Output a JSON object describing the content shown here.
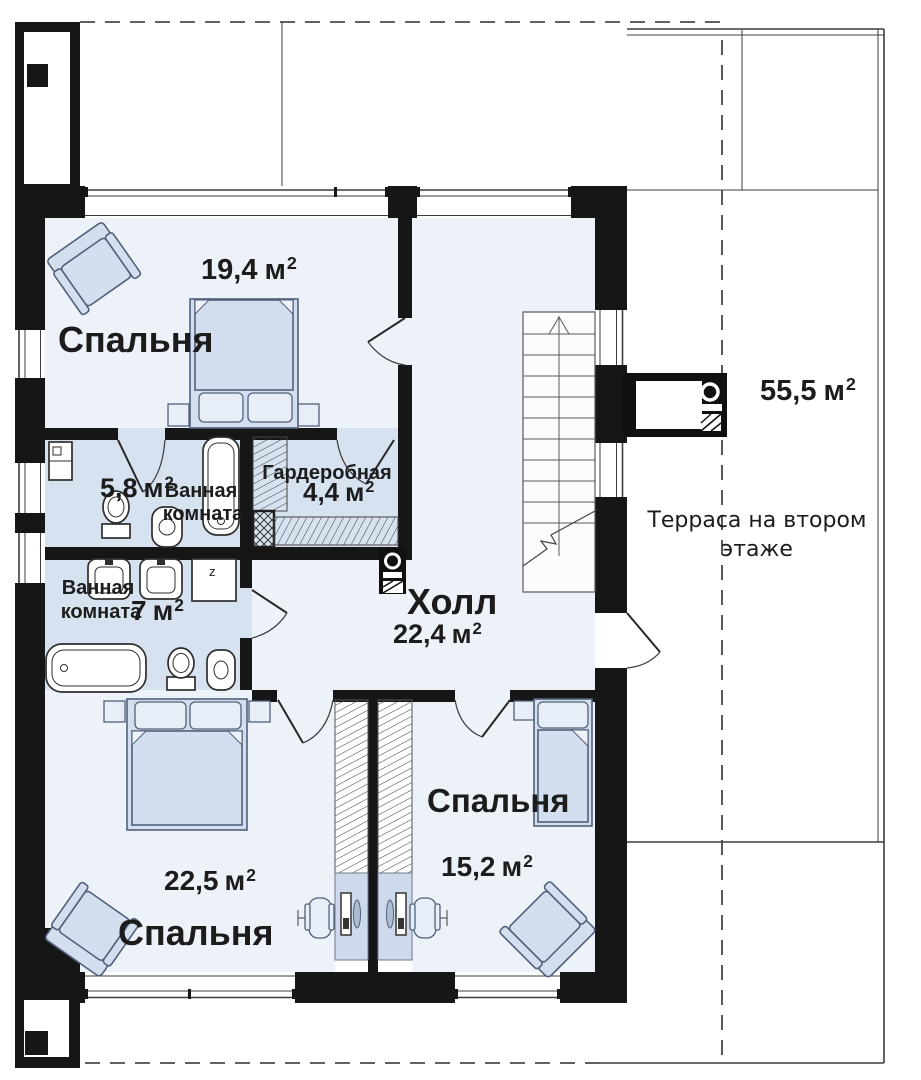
{
  "palette": {
    "wall": "#161616",
    "room": "#edf2f9",
    "wet": "#d7e2f1",
    "alcove": "#cddaeb",
    "furn": "#d3dfee",
    "furnLight": "#e8eef7",
    "outline": "#51617a",
    "text": "#1c1c1c"
  },
  "units": {
    "label": "м",
    "sup": "2"
  },
  "appliances": {
    "washer_label": "z"
  },
  "rooms": {
    "bedroom1": {
      "name": "Спальня",
      "area": "19,4"
    },
    "bathroom1": {
      "name_line1": "Ванная",
      "name_line2": "комната",
      "area": "5,8"
    },
    "wardrobe": {
      "name": "Гардеробная",
      "area": "4,4"
    },
    "bathroom2": {
      "name_line1": "Ванная",
      "name_line2": "комната",
      "area": "7"
    },
    "hall": {
      "name": "Холл",
      "area": "22,4"
    },
    "bedroom2": {
      "name": "Спальня",
      "area": "22,5"
    },
    "bedroom3": {
      "name": "Спальня",
      "area": "15,2"
    },
    "terrace": {
      "name_line1": "Терраса на втором",
      "name_line2": "этаже",
      "area": "55,5"
    }
  }
}
